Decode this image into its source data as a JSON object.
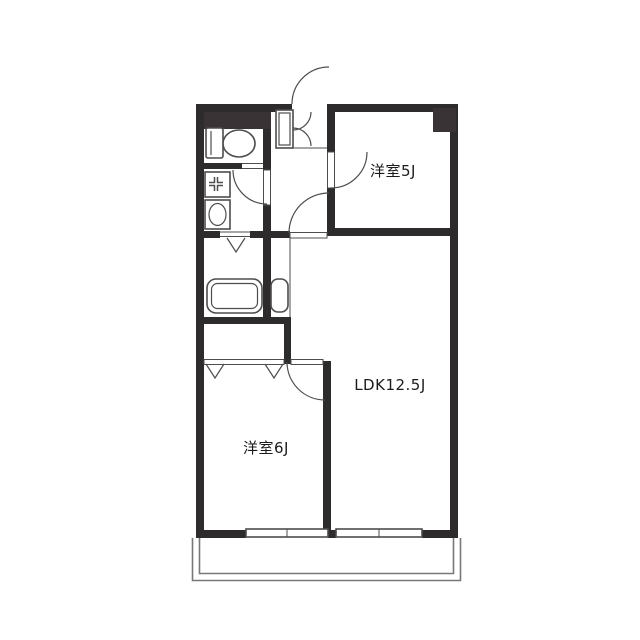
{
  "colors": {
    "wall": "#2e2b2c",
    "block": "#3a3335",
    "line": "#4d4d4d",
    "thin": "#787878",
    "text": "#1b1b1b",
    "bg": "#ffffff"
  },
  "floorplan": {
    "type": "apartment-floor-plan",
    "rooms": [
      {
        "id": "western-room-5j",
        "label": "洋室5J"
      },
      {
        "id": "ldk",
        "label": "LDK12.5J"
      },
      {
        "id": "western-room-6j",
        "label": "洋室6J"
      }
    ],
    "unlabeled_areas": [
      "entrance",
      "hallway",
      "toilet",
      "washroom",
      "bathroom",
      "closet",
      "balcony"
    ],
    "fixtures": [
      "toilet",
      "washing-machine-pan",
      "washbasin",
      "bathtub",
      "vanity-cabinet",
      "shoe-cabinet"
    ],
    "openings": [
      "entrance-door",
      "washroom-door",
      "room5j-door",
      "ldk-door",
      "room6j-door",
      "bathroom-folding-door",
      "closet-folding-doors",
      "window-room6j",
      "window-ldk"
    ]
  }
}
